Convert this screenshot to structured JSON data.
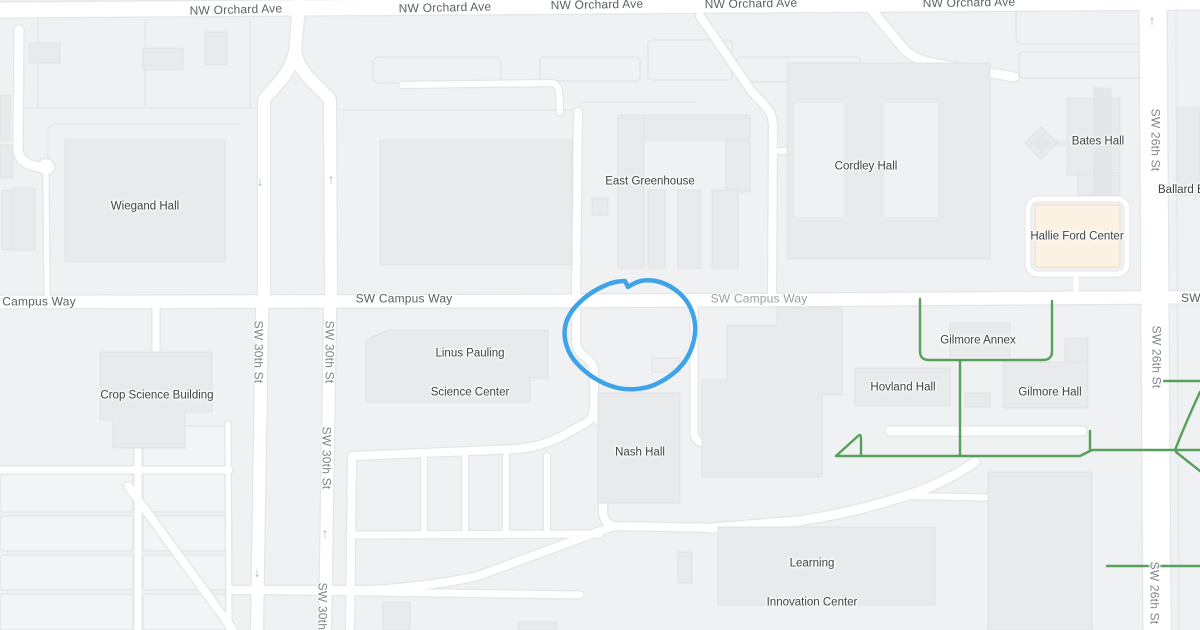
{
  "map_type": "campus-street-map",
  "annotation": {
    "shape": "freehand-circle",
    "color": "#3fa3e8",
    "target_area": "lot on SW Campus Way east of Linus Pauling Science Center"
  },
  "streets": {
    "nw_orchard_ave": "NW Orchard Ave",
    "campus_way": "Campus Way",
    "sw_campus_way": "SW Campus Way",
    "sw_30th_st": "SW 30th St",
    "sw_26th_st": "SW 26th St"
  },
  "buildings": {
    "wiegand": "Wiegand Hall",
    "east_greenhouse": "East Greenhouse",
    "cordley": "Cordley Hall",
    "bates": "Bates Hall",
    "ballard": "Ballard Ex",
    "hallie_ford": "Hallie Ford Center",
    "crop_science": "Crop Science Building",
    "linus_pauling_line1": "Linus Pauling",
    "linus_pauling_line2": "Science Center",
    "hovland": "Hovland Hall",
    "gilmore_annex": "Gilmore Annex",
    "gilmore_hall": "Gilmore Hall",
    "nash": "Nash Hall",
    "lic_line1": "Learning",
    "lic_line2": "Innovation Center"
  },
  "icons": {
    "one_way_up_arrow": "↑",
    "one_way_down_arrow": "↓",
    "bike_path": "green-line",
    "point_of_interest": "cream-building"
  },
  "colors": {
    "bg": "#f0f1f3",
    "bldg": "#e9eaec",
    "bldg_border": "#dfe2e6",
    "road": "#ffffff",
    "road_border": "#e3e6ea",
    "poi": "#fbf2e3",
    "poi_border": "#eddfc6",
    "green": "#57a05c",
    "blue": "#3fa3e8",
    "label_dark": "#3e4347",
    "street_dark": "#5c6165",
    "street_light": "#9aa0a7",
    "arrow": "#a9b1c6"
  }
}
